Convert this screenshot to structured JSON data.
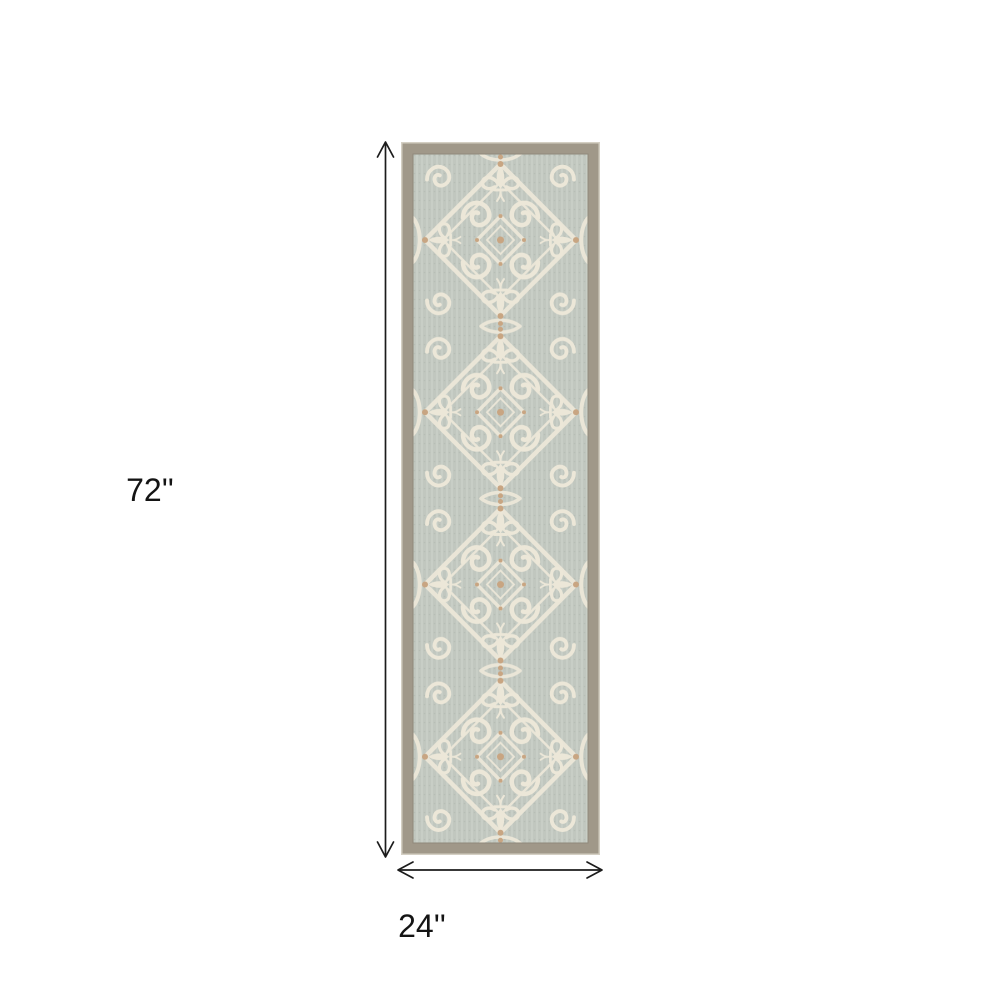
{
  "diagram": {
    "type": "product-dimension-diagram",
    "subject": "Runner rug with ornate ivory scrollwork damask pattern on gray field with taupe border, shown on white background with dimension arrows",
    "height": {
      "label": "72''",
      "value": 72,
      "unit": "inches"
    },
    "width": {
      "label": "24''",
      "value": 24,
      "unit": "inches"
    }
  },
  "rug": {
    "description": "Gray and ivory damask scrollwork runner rug",
    "colors": {
      "border_band": "#a09889",
      "outer_edge": "#d4cfc3",
      "inner_edge": "#8f887a",
      "field": "#c1c7bf",
      "field_texture": "#cdd3cb",
      "pattern_ivory": "#ece7d8",
      "accent_tan": "#c8a582"
    }
  },
  "annotation": {
    "line_color": "#1c1c1c",
    "text_color": "#141414"
  }
}
